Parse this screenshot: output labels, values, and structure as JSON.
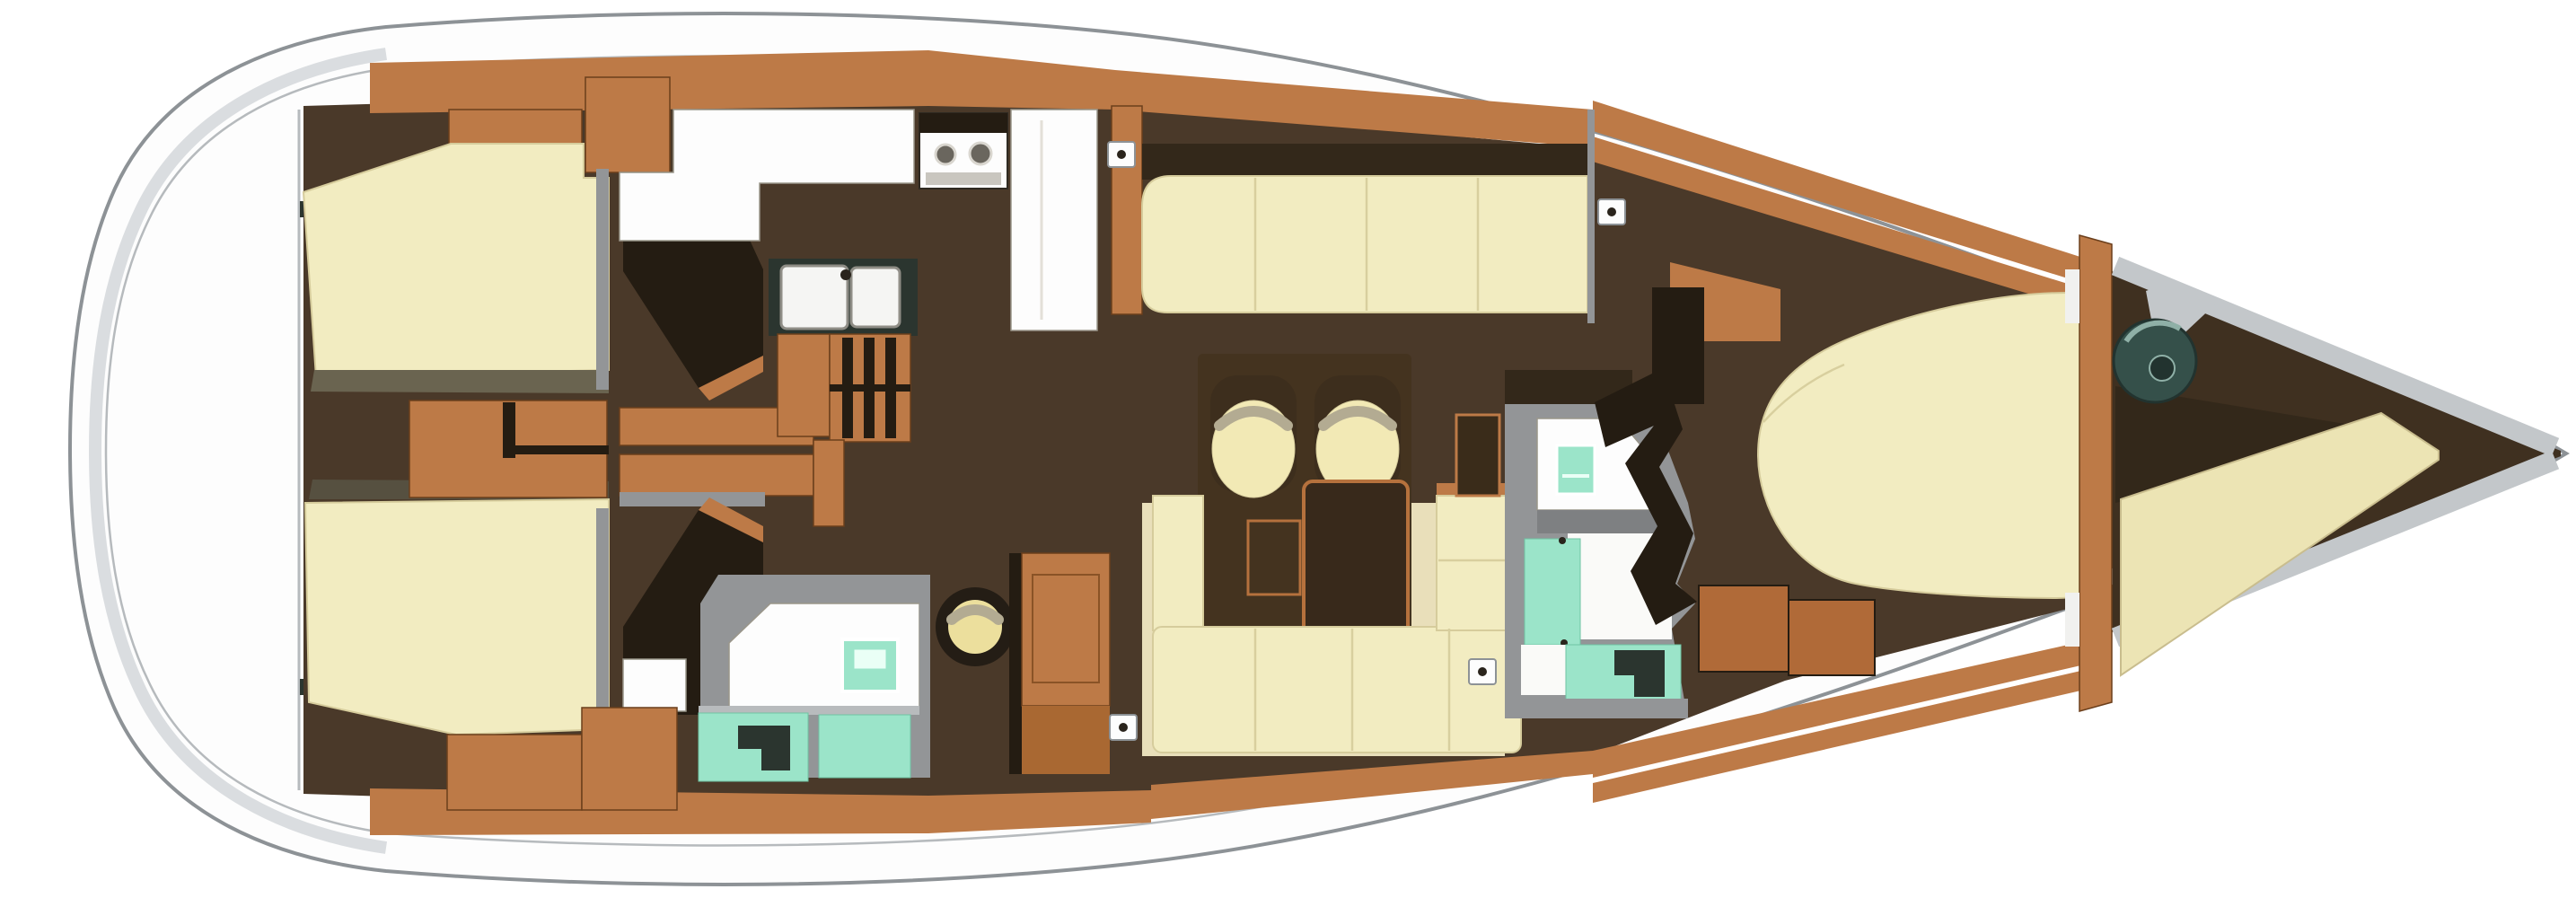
{
  "diagram": {
    "title": "sailing-yacht-interior-floor-plan-top-view",
    "view": "top-down",
    "orientation": {
      "stern": "left",
      "bow": "right"
    },
    "portlight_count": 4,
    "areas": [
      {
        "name": "swim-platform-transom",
        "features": [
          "rounded-white-stern-cap"
        ]
      },
      {
        "name": "aft-owners-cabin",
        "features": [
          "port-berth",
          "starboard-berth",
          "center-drawer-unit",
          "side-drawer-bank",
          "port-wardrobe",
          "starboard-wardrobe",
          "vanity-counter"
        ]
      },
      {
        "name": "galley",
        "features": [
          "two-burner-stove",
          "refrigerator-column",
          "double-sink",
          "companionway-steps",
          "mast-post"
        ]
      },
      {
        "name": "aft-head",
        "features": [
          "washbasin-counter",
          "teal-washbasin",
          "shower-pan",
          "toilet-area"
        ]
      },
      {
        "name": "navigation-station",
        "features": [
          "chart-table",
          "round-stool"
        ]
      },
      {
        "name": "salon",
        "features": [
          "port-settee",
          "l-shaped-starboard-settee",
          "armchair-pair",
          "dining-table",
          "side-table",
          "storage-locker"
        ]
      },
      {
        "name": "forward-head",
        "features": [
          "washbasin-counter",
          "teal-washbasin",
          "shower-stall",
          "toilet-area"
        ]
      },
      {
        "name": "forward-cabin",
        "features": [
          "island-double-berth",
          "entry-steps",
          "forward-bulkhead"
        ]
      },
      {
        "name": "bow-compartment",
        "features": [
          "anchor-windlass",
          "deck-hatch-plate",
          "chain-locker",
          "v-bench"
        ]
      }
    ]
  },
  "palette": {
    "hull_fill": "#fdfdfd",
    "hull_stroke": "#8d9296",
    "stern_shade": "#d3d7da",
    "rim_line": "#b6babd",
    "floor_dark": "#4a3929",
    "floor_darker": "#3f3020",
    "wood_tan": "#bd7a47",
    "wood_line": "#6b3f1c",
    "wood_trim": "#b5713d",
    "wood_step": "#b06a38",
    "wood_deep": "#a96832",
    "wood_dark": "#33281a",
    "wall_darkest": "#241c12",
    "olive": "#6a6450",
    "olive_dark": "#565040",
    "cream": "#f2ecc1",
    "cream_edge": "#d6cc9c",
    "cream_seam": "#d8cf9e",
    "sole_pale": "#e9dfba",
    "seat_cream": "#f2e9b5",
    "seat_back": "#3d2e1d",
    "crescent": "#b3ab92",
    "platform": "#44331f",
    "table_dark": "#38291b",
    "white_fixture": "#fdfdfd",
    "fixture_line": "#9a968a",
    "fixture_dark": "#2b352f",
    "gray_wall": "#939597",
    "gray_band": "#7e8082",
    "gray_light": "#c3c7ca",
    "teal": "#9be4c9",
    "teal_edge": "#6fc3a4",
    "teal_inner": "#eafff6",
    "slate": "#35504a",
    "slate_edge": "#22332f",
    "slate_glint": "#8fb0a7",
    "stool_ring": "#241d15",
    "stool_seat": "#ecdf9d",
    "stove_band": "#2f2a22",
    "burner": "#6a665e",
    "oven": "#d9d6cf",
    "oven_door": "#c9c6bf",
    "dot_dark": "#2a241c"
  }
}
